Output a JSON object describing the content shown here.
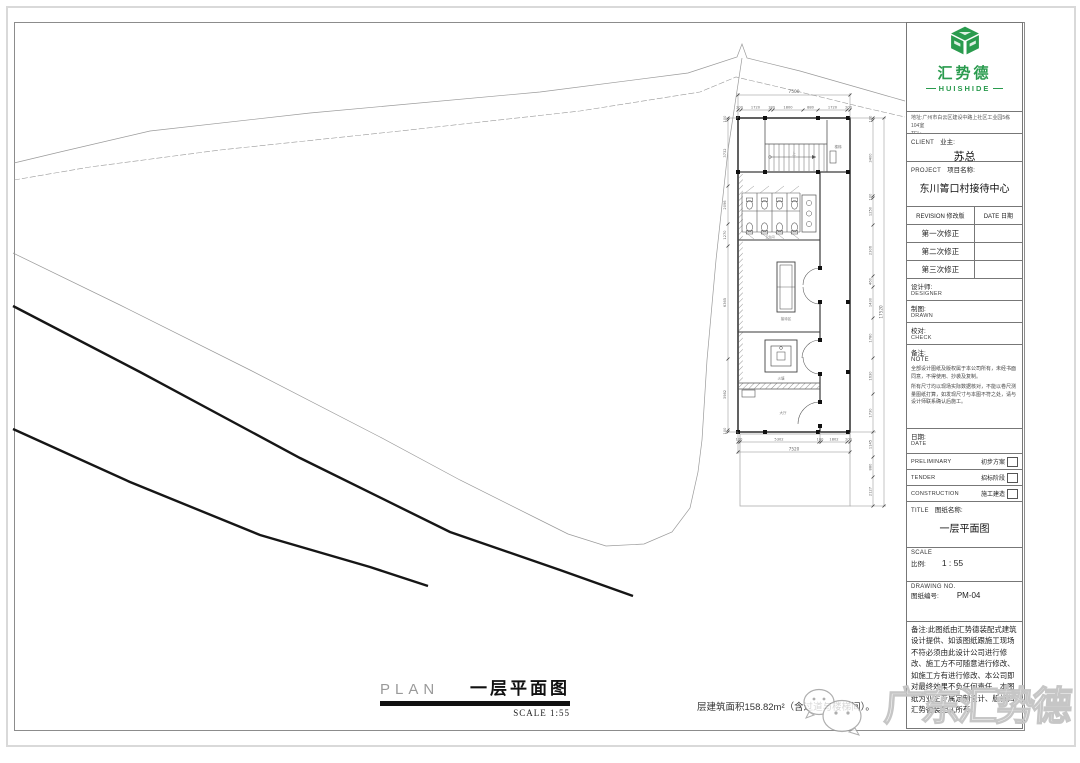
{
  "title_block": {
    "logo": {
      "name_cn": "汇势德",
      "name_en": "HUISHIDE"
    },
    "address": "地址:广州市白云区建设中路上社区工业园5栋104室",
    "tel": "TEL:",
    "client": {
      "en": "CLIENT",
      "cn": "业主:",
      "value": "苏总"
    },
    "project": {
      "en": "PROJECT",
      "cn": "项目名称:",
      "value": "东川箐口村接待中心"
    },
    "revision": {
      "header_left": "REVISION  修改版",
      "header_right": "DATE  日期",
      "rows": [
        "第一次修正",
        "第二次修正",
        "第三次修正"
      ]
    },
    "designer": {
      "cn": "设计师:",
      "en": "DESIGNER"
    },
    "drawn": {
      "cn": "制图:",
      "en": "DRAWN"
    },
    "check": {
      "cn": "校对:",
      "en": "CHECK"
    },
    "note": {
      "cn": "备注:",
      "en": "NOTE",
      "p1": "全部设计图纸及版权属于本公司所有，未经书面同意，不得使用、抄袭及复制。",
      "p2": "所有尺寸均以现场实际数据核对，不能以卷尺测量图纸打算，如发现尺寸与本图不符之处，请与设计师联系确认后施工。"
    },
    "date": {
      "cn": "日期:",
      "en": "DATE"
    },
    "phases": [
      {
        "en": "PRELIMINARY",
        "cn": "初步方案"
      },
      {
        "en": "TENDER",
        "cn": "招标阶段"
      },
      {
        "en": "CONSTRUCTION",
        "cn": "施工建造"
      }
    ],
    "sheet_title": {
      "en": "TITLE",
      "cn": "图纸名称:",
      "value": "一层平面图"
    },
    "scale": {
      "en": "SCALE",
      "cn": "比例:",
      "value": "1 : 55"
    },
    "drawing_no": {
      "en": "DRAWING NO.",
      "cn": "图纸编号:",
      "value": "PM-04"
    },
    "bottom_note": "备注:此图纸由汇势德装配式建筑设计提供、如该图纸跟施工现场不符必须由此设计公司进行修改、施工方不可随意进行修改、如施工方有进行修改、本公司即对最终效果不负任何责任、本图纸为业主专属定制设计、版权归汇势德装配式所有。"
  },
  "plan": {
    "title_en": "PLAN",
    "title_cn": "一层平面图",
    "scale_note": "SCALE  1:55",
    "area_note": "层建筑面积158.82m²（含过道与楼梯间）。",
    "overall_top": "7500",
    "top_dims": [
      "200",
      "1720",
      "180",
      "1800",
      "880",
      "1720",
      "200"
    ],
    "overall_bottom": "7520",
    "bottom_dims": [
      "100",
      "5302",
      "100",
      "1802",
      "200"
    ],
    "overall_right": "17520",
    "right_dims": [
      "100",
      "3400",
      "100",
      "1250",
      "2306",
      "460",
      "1430",
      "1780",
      "1630",
      "1730",
      "1145",
      "880",
      "2127"
    ],
    "left_dims": [
      "100",
      "3732",
      "2096",
      "1270",
      "6365",
      "3982",
      "100"
    ],
    "labels": {
      "stair": "楼梯",
      "up": "上",
      "wc": "卫生间",
      "meeting": "接待区",
      "firepit": "火塘",
      "hall": "大厅"
    }
  },
  "watermark": "广东汇势德",
  "colors": {
    "brand_green": "#2a9b4e",
    "line": "#8a8a8a",
    "bold_line": "#161616"
  }
}
